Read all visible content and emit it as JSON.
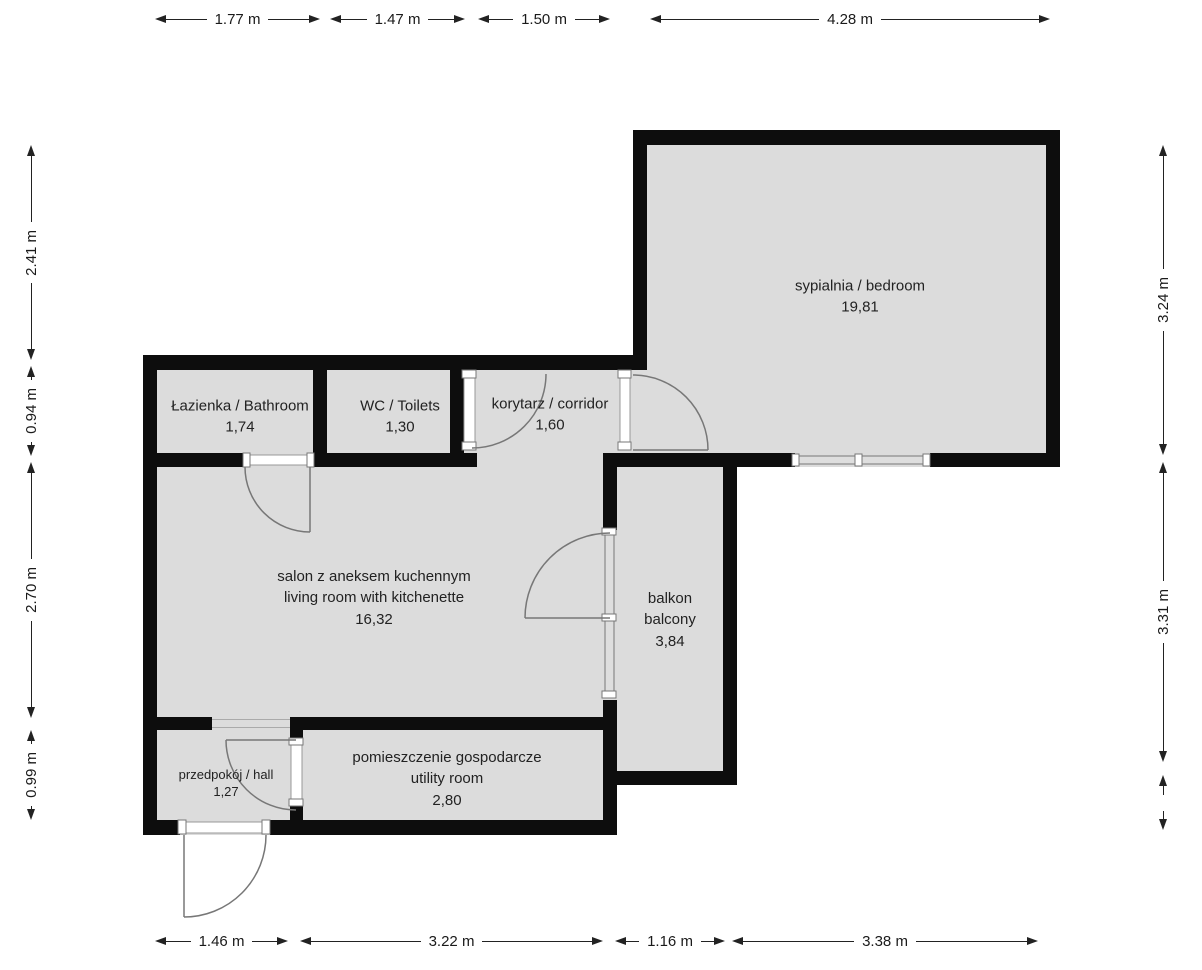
{
  "colors": {
    "wall": "#0d0d0d",
    "floor": "#dcdcdc",
    "background": "#ffffff",
    "door_line": "#777777",
    "dimension_text": "#1a1a1a"
  },
  "rooms": {
    "bedroom": {
      "name": "sypialnia / bedroom",
      "area": "19,81"
    },
    "bathroom": {
      "name": "Łazienka / Bathroom",
      "area": "1,74"
    },
    "wc": {
      "name": "WC / Toilets",
      "area": "1,30"
    },
    "corridor": {
      "name": "korytarz / corridor",
      "area": "1,60"
    },
    "living": {
      "name": "salon z aneksem kuchennym",
      "name_en": "living room with kitchenette",
      "area": "16,32"
    },
    "balcony": {
      "name": "balkon",
      "name_en": "balcony",
      "area": "3,84"
    },
    "hall": {
      "name": "przedpokój / hall",
      "area": "1,27"
    },
    "utility": {
      "name": "pomieszczenie gospodarcze",
      "name_en": "utility room",
      "area": "2,80"
    }
  },
  "dimensions": {
    "top": [
      {
        "label": "1.77 m"
      },
      {
        "label": "1.47 m"
      },
      {
        "label": "1.50 m"
      },
      {
        "label": "4.28 m"
      }
    ],
    "bottom": [
      {
        "label": "1.46 m"
      },
      {
        "label": "3.22 m"
      },
      {
        "label": "1.16 m"
      },
      {
        "label": "3.38 m"
      }
    ],
    "left": [
      {
        "label": "2.41 m"
      },
      {
        "label": "0.94 m"
      },
      {
        "label": "2.70 m"
      },
      {
        "label": "0.99 m"
      }
    ],
    "right": [
      {
        "label": "3.24 m"
      },
      {
        "label": "3.31 m"
      },
      {
        "label": ""
      }
    ]
  }
}
